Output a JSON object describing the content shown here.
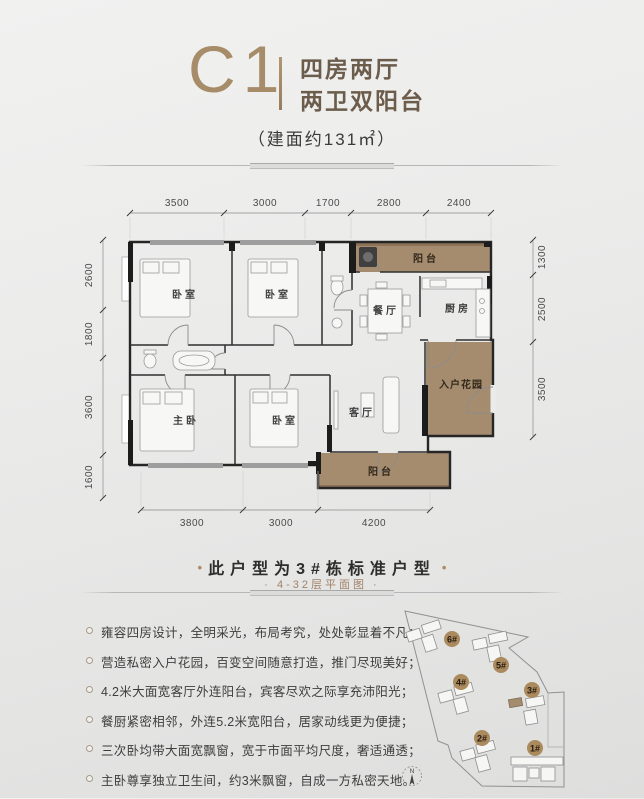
{
  "header": {
    "unit_code": "C1",
    "subtitle_line1": "四房两厅",
    "subtitle_line2": "两卫双阳台",
    "area_note": "（建面约131㎡）"
  },
  "floor_plan": {
    "dims_top": [
      "3500",
      "3000",
      "1700",
      "2800",
      "2400"
    ],
    "dims_left": [
      "2600",
      "1800",
      "3600",
      "1600"
    ],
    "dims_right": [
      "1300",
      "2500",
      "3500"
    ],
    "dims_bottom": [
      "3800",
      "3000",
      "4200"
    ],
    "rooms": {
      "bedroom_top_left": "卧室",
      "bedroom_top_mid": "卧室",
      "balcony_top": "阳台",
      "dining": "餐厅",
      "kitchen": "厨房",
      "master_bedroom": "主卧",
      "bedroom_bottom_mid": "卧室",
      "living": "客厅",
      "entry_garden": "入户花园",
      "balcony_bottom": "阳台"
    }
  },
  "standard_note": {
    "dot": "•",
    "title": "此户型为3#栋标准户型",
    "subtitle": "· 4-32层平面图 ·"
  },
  "features": [
    "雍容四房设计，全明采光，布局考究，处处彰显着不凡；",
    "营造私密入户花园，百变空间随意打造，推门尽现美好；",
    "4.2米大面宽客厅外连阳台，宾客尽欢之际享充沛阳光；",
    "餐厨紧密相邻，外连5.2米宽阳台，居家动线更为便捷；",
    "三次卧均带大面宽飘窗，宽于市面平均尺度，奢适通透；",
    "主卧尊享独立卫生间，约3米飘窗，自成一方私密天地。"
  ],
  "site_map": {
    "buildings": [
      "6#",
      "5#",
      "4#",
      "3#",
      "2#",
      "1#"
    ],
    "compass_label": "N"
  },
  "colors": {
    "accent_tan": "#a68c68",
    "plan_brown": "#a58c6e",
    "badge_brown": "#ab8a5e",
    "subtitle_brown": "#a1836a",
    "text_dark": "#3a3a3a"
  }
}
